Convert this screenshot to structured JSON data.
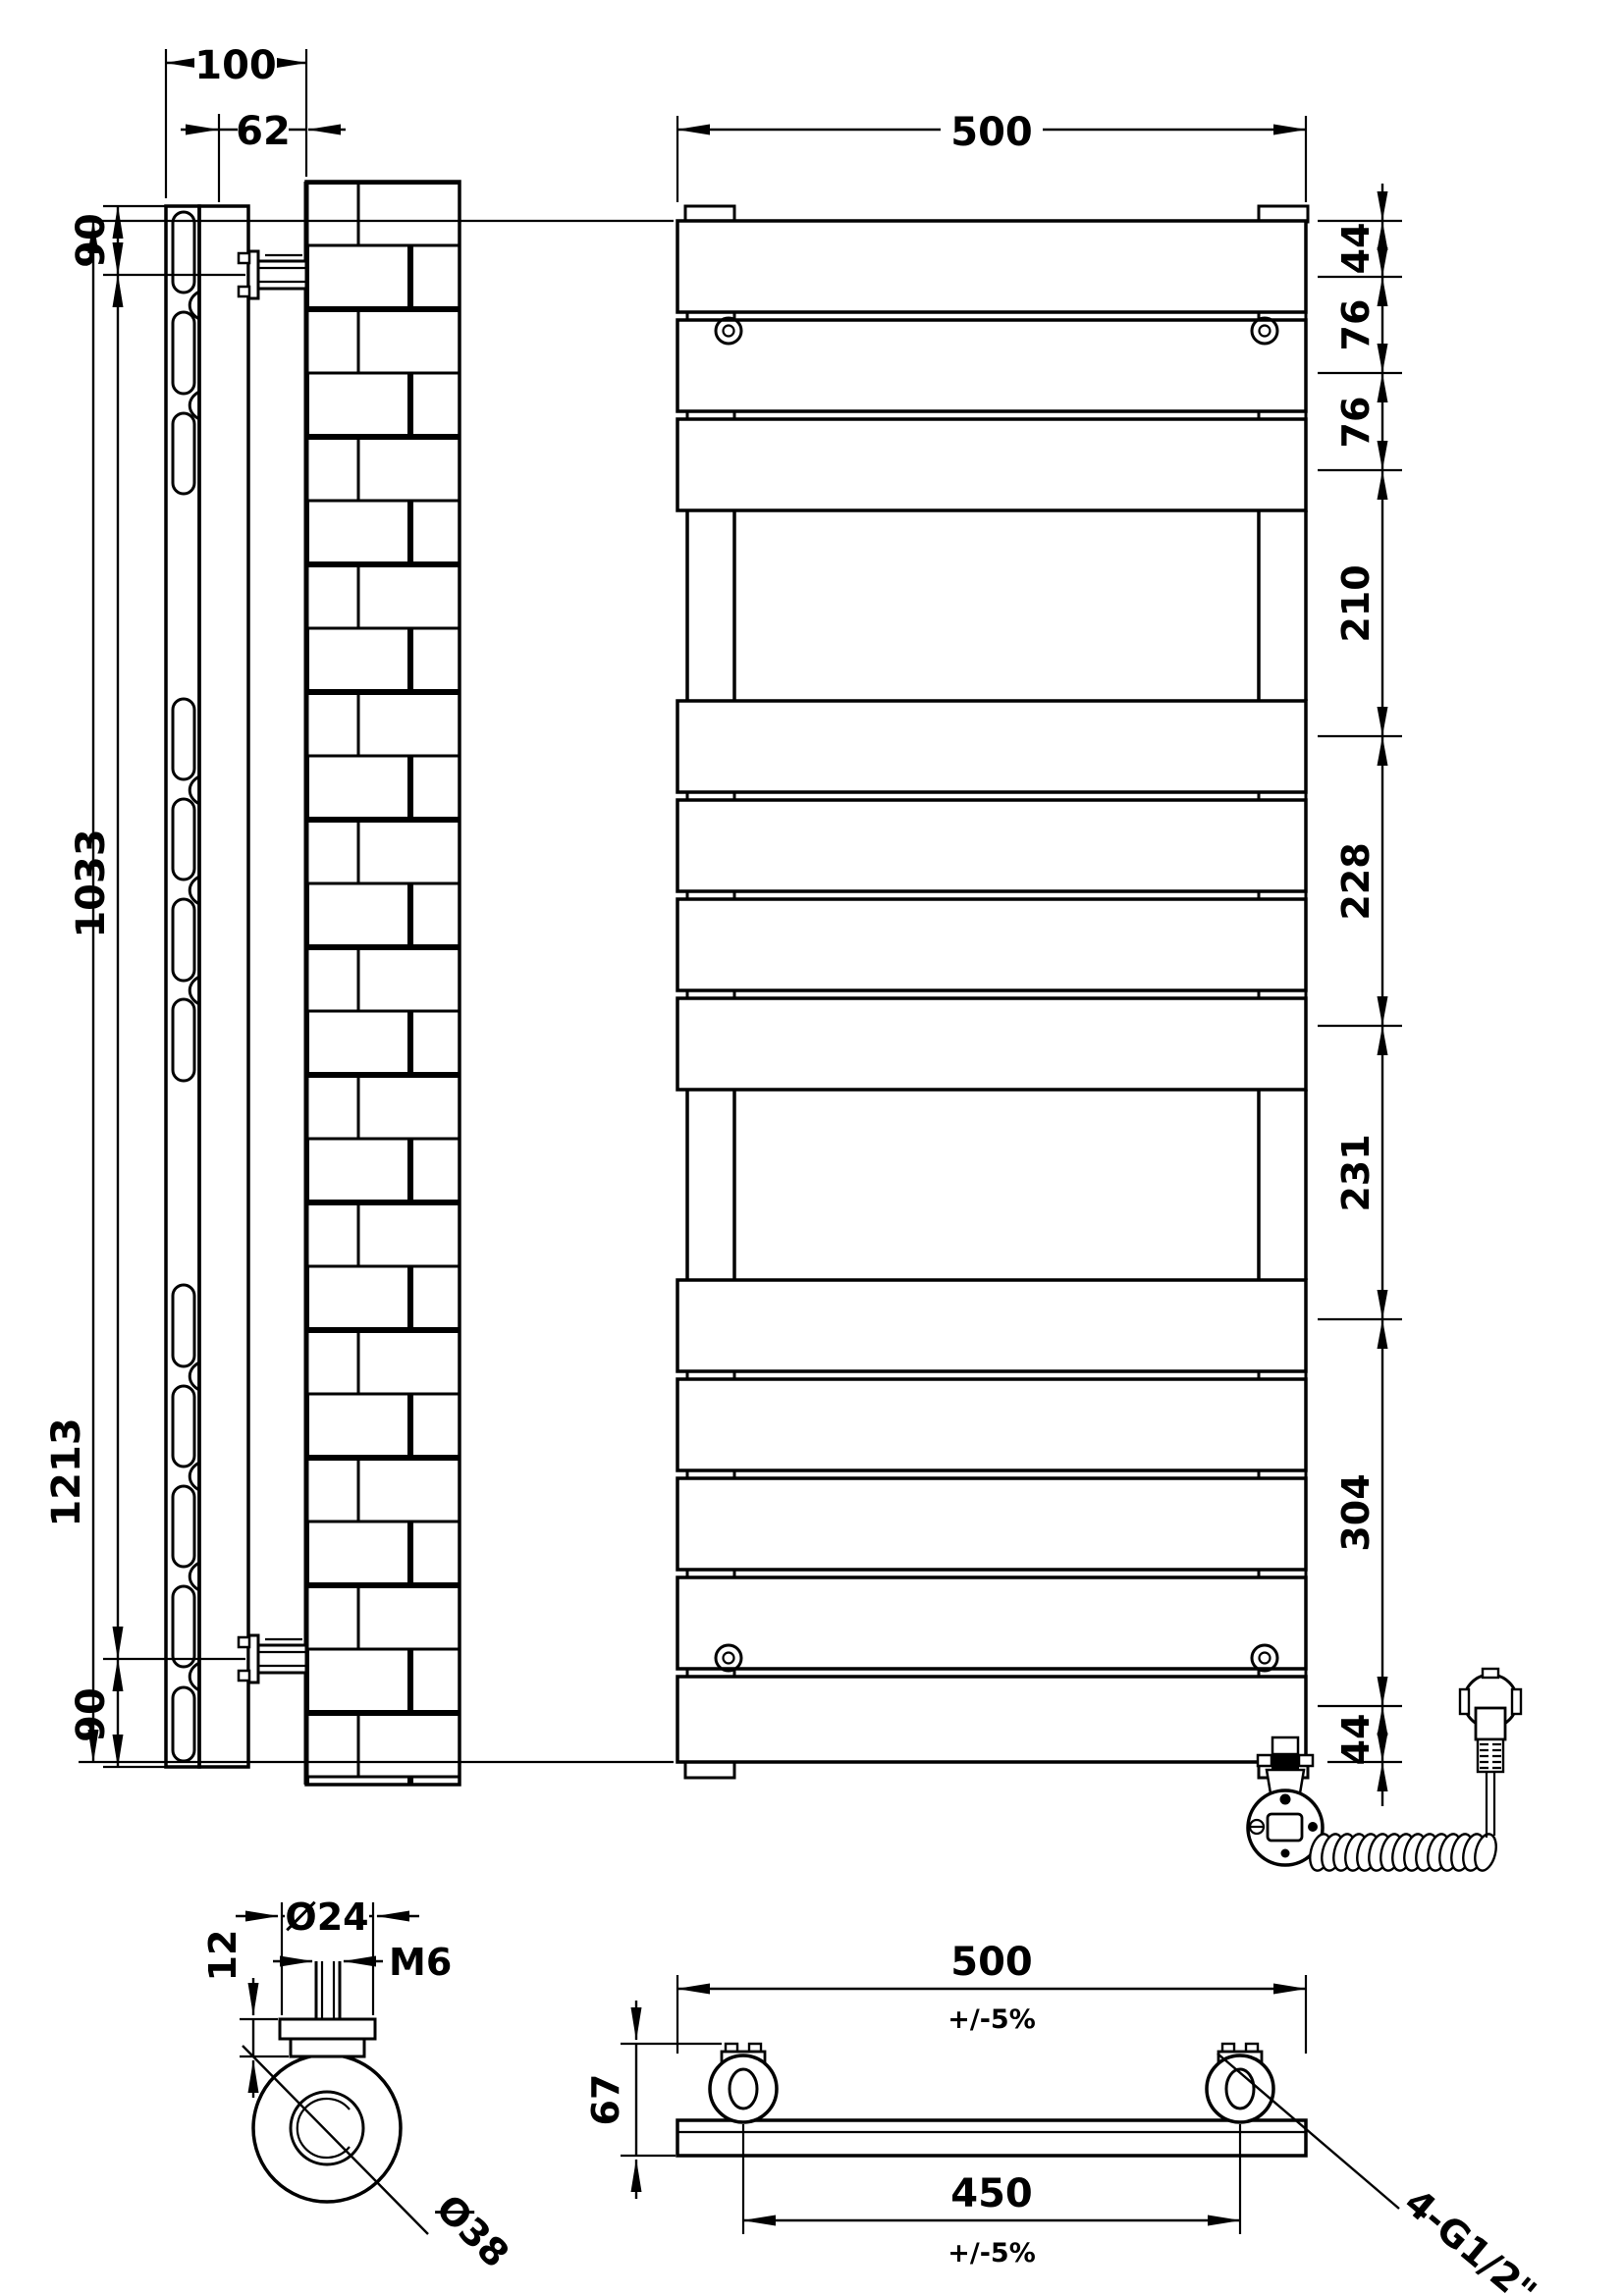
{
  "drawing_type": "technical-dimension-drawing",
  "subject": "flat-panel heated towel rail with electric element",
  "views": {
    "side": {
      "label": "side-elevation-on-wall",
      "dims": {
        "overall_depth": "100",
        "wall_to_bracket": "62",
        "top_to_bracket": "90",
        "bracket_centres": "1033",
        "bracket_to_bottom": "90"
      }
    },
    "front": {
      "label": "front-elevation",
      "dims": {
        "overall_width": "500",
        "overall_height": "1213",
        "right_chain": [
          "44",
          "76",
          "76",
          "210",
          "228",
          "231",
          "304",
          "44"
        ]
      }
    },
    "bracket_detail": {
      "label": "wall-bracket-detail",
      "dims": {
        "collar_diameter": "Ø24",
        "stud_thread": "M6",
        "collar_depth": "12",
        "base_diameter": "Ø38"
      }
    },
    "plan": {
      "label": "plan-view",
      "dims": {
        "overall_width": "500",
        "overall_width_tolerance": "+/-5%",
        "depth": "67",
        "connection_centres": "450",
        "connection_centres_tolerance": "+/-5%",
        "connections": "4-G1/2\""
      }
    }
  },
  "colors": {
    "line": "#000000",
    "background": "#ffffff"
  }
}
